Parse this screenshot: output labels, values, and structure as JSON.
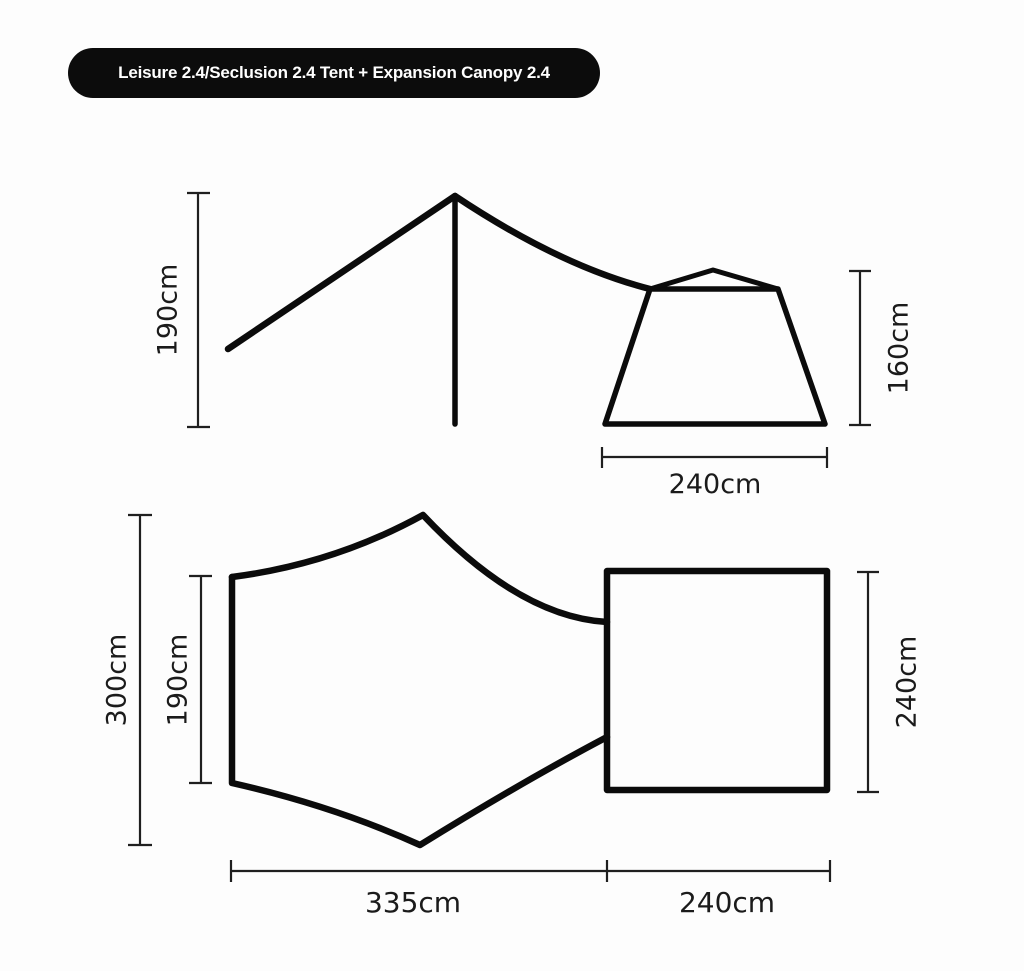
{
  "badge": {
    "label": "Leisure 2.4/Seclusion 2.4 Tent + Expansion Canopy 2.4"
  },
  "colors": {
    "ink": "#0b0b0b",
    "dim_line": "#1f1f1f",
    "label_text": "#1b1b1b",
    "badge_bg": "#0c0c0c",
    "badge_text": "#ffffff",
    "background": "#fdfdfd"
  },
  "side_view": {
    "canopy_height": "190cm",
    "tent_height": "160cm",
    "tent_width": "240cm"
  },
  "top_view": {
    "canopy_full_depth": "300cm",
    "canopy_panel_depth": "190cm",
    "tent_depth": "240cm",
    "canopy_width": "335cm",
    "tent_width": "240cm"
  }
}
